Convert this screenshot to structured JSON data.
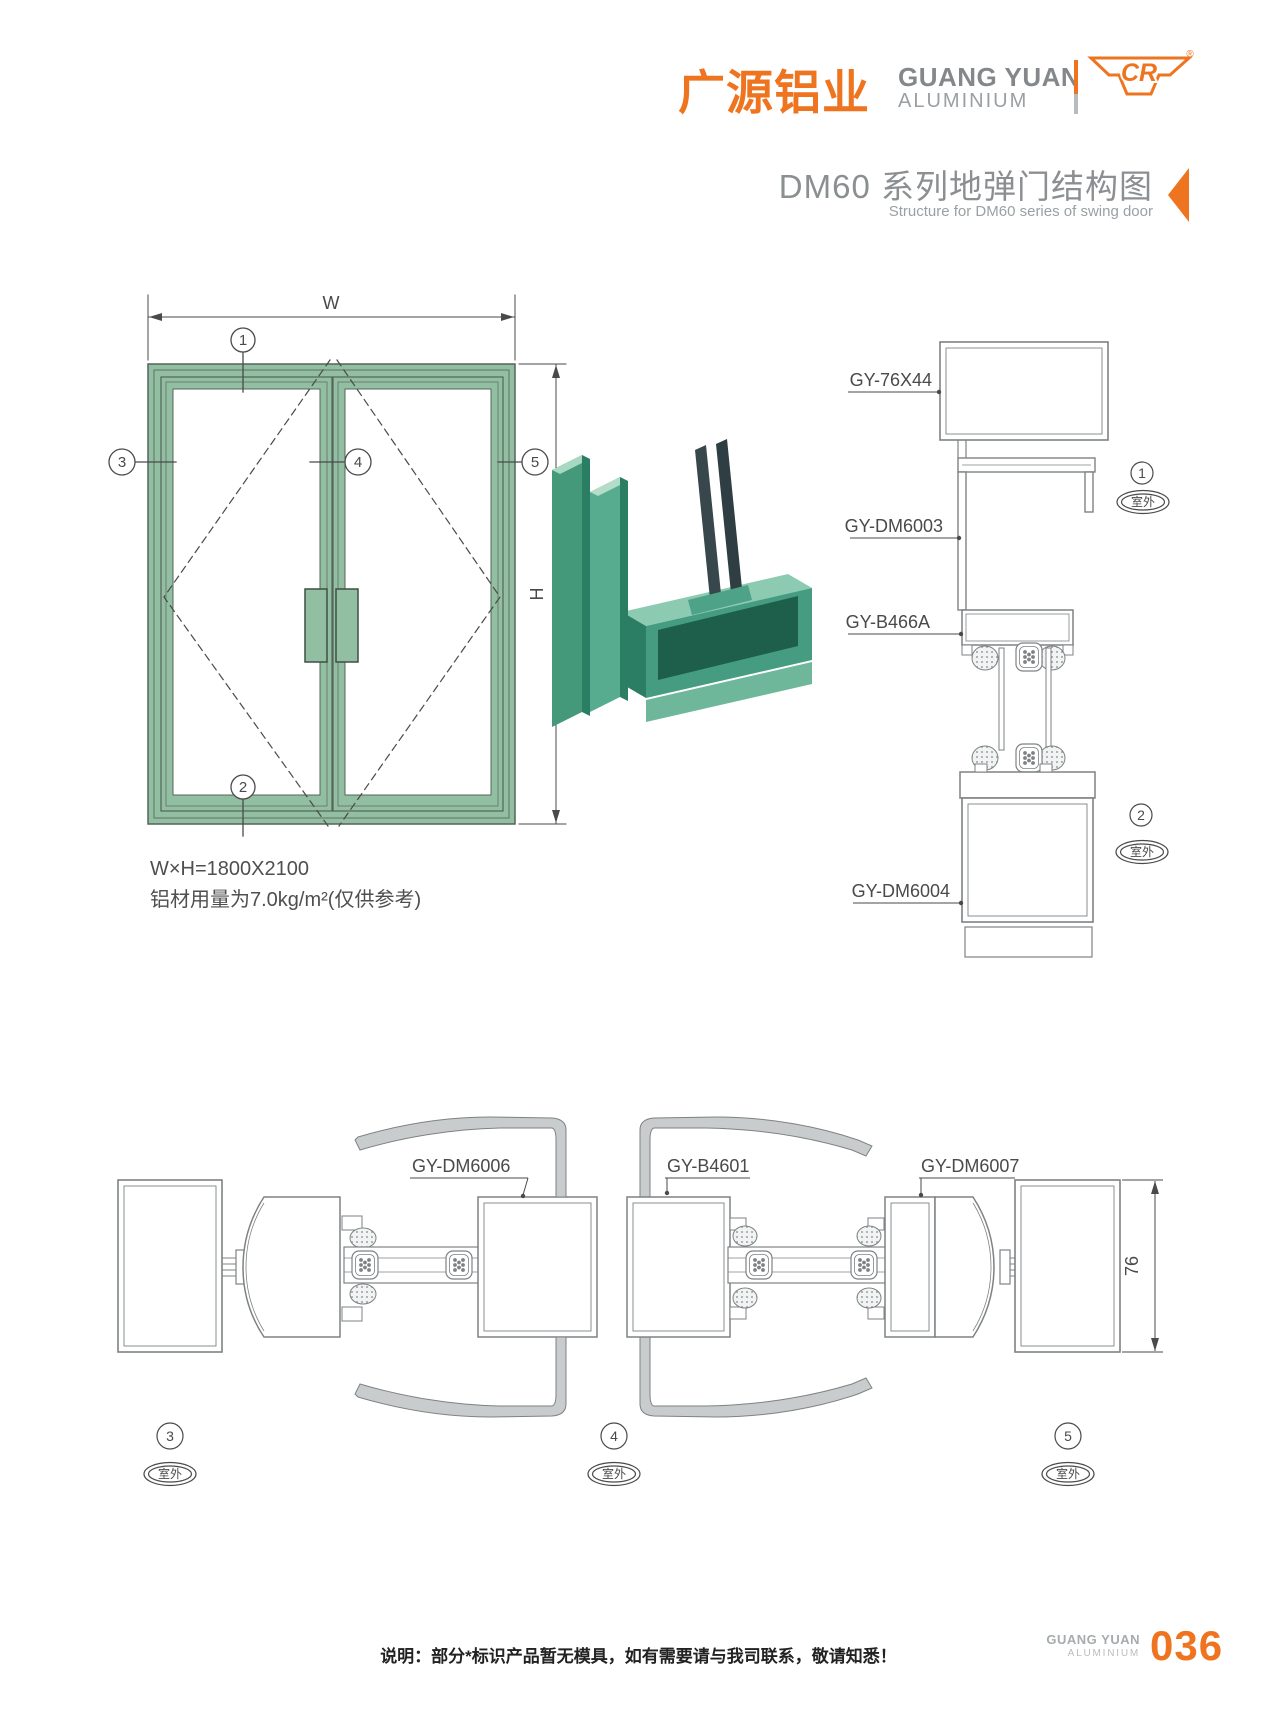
{
  "header": {
    "logo_cn": "广源铝业",
    "logo_en_line1": "GUANG YUAN",
    "logo_en_line2": "ALUMINIUM",
    "mark_text": "CR",
    "mark_registered": "®",
    "title_cn": "DM60 系列地弹门结构图",
    "title_en": "Structure for DM60 series of swing door"
  },
  "elevation": {
    "dim_width_label": "W",
    "dim_height_label": "H",
    "spec_line1": "W×H=1800X2100",
    "spec_line2": "铝材用量为7.0kg/m²(仅供参考)",
    "markers": {
      "m1": "1",
      "m2": "2",
      "m3": "3",
      "m4": "4",
      "m5": "5"
    }
  },
  "vertical_section": {
    "labels": {
      "top_box": "GY-76X44",
      "frame_head": "GY-DM6003",
      "gasket": "GY-B466A",
      "bottom_rail": "GY-DM6004"
    },
    "markers": {
      "m1": "1",
      "m2": "2"
    }
  },
  "horizontal_section": {
    "labels": {
      "leaf_left": "GY-DM6006",
      "weatherstrip": "GY-B4601",
      "leaf_right": "GY-DM6007"
    },
    "dim_depth": "76",
    "markers": {
      "m3": "3",
      "m4": "4",
      "m5": "5"
    }
  },
  "shared": {
    "outdoor_label": "室外"
  },
  "footer": {
    "note": "说明：部分*标识产品暂无模具，如有需要请与我司联系，敬请知悉！",
    "brand_line1": "GUANG YUAN",
    "brand_line2": "ALUMINIUM",
    "page_number": "036"
  },
  "colors": {
    "accent_orange": "#ee7420",
    "door_green": "#92bea1",
    "door_green_stroke": "#55645a",
    "drawing_gray": "#7e8284",
    "dim_gray": "#4a4a4a",
    "render_green_dark": "#2b7d63",
    "render_green_mid": "#4da287",
    "render_green_light": "#8ccbb1"
  }
}
